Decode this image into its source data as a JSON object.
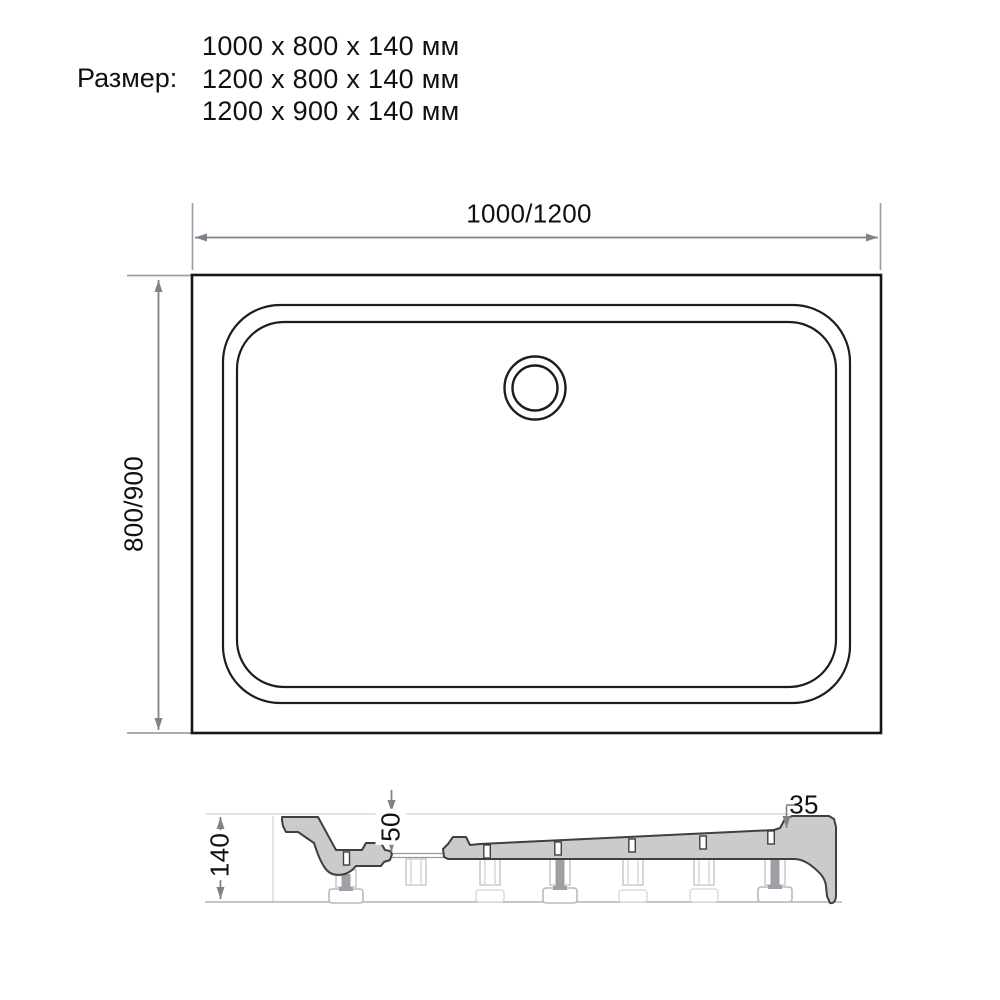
{
  "size_block": {
    "label": "Размер:",
    "options": [
      "1000 x 800 x 140 мм",
      "1200 x 800 x 140 мм",
      "1200 x 900 x 140 мм"
    ]
  },
  "top_view": {
    "description": "shower tray plan view with drain",
    "width_dimension": "1000/1200",
    "height_dimension": "800/900"
  },
  "side_view": {
    "description": "shower tray cross-section on adjustable feet",
    "total_height_dimension": "140",
    "basin_depth_dimension": "50",
    "rim_height_dimension": "35"
  },
  "colors": {
    "outline": "#1a1a1a",
    "dimension_line": "#7d838b",
    "section_fill": "#cbcbcb",
    "section_outline": "#3f3f3f",
    "ghost_line": "#c9cdd1"
  }
}
